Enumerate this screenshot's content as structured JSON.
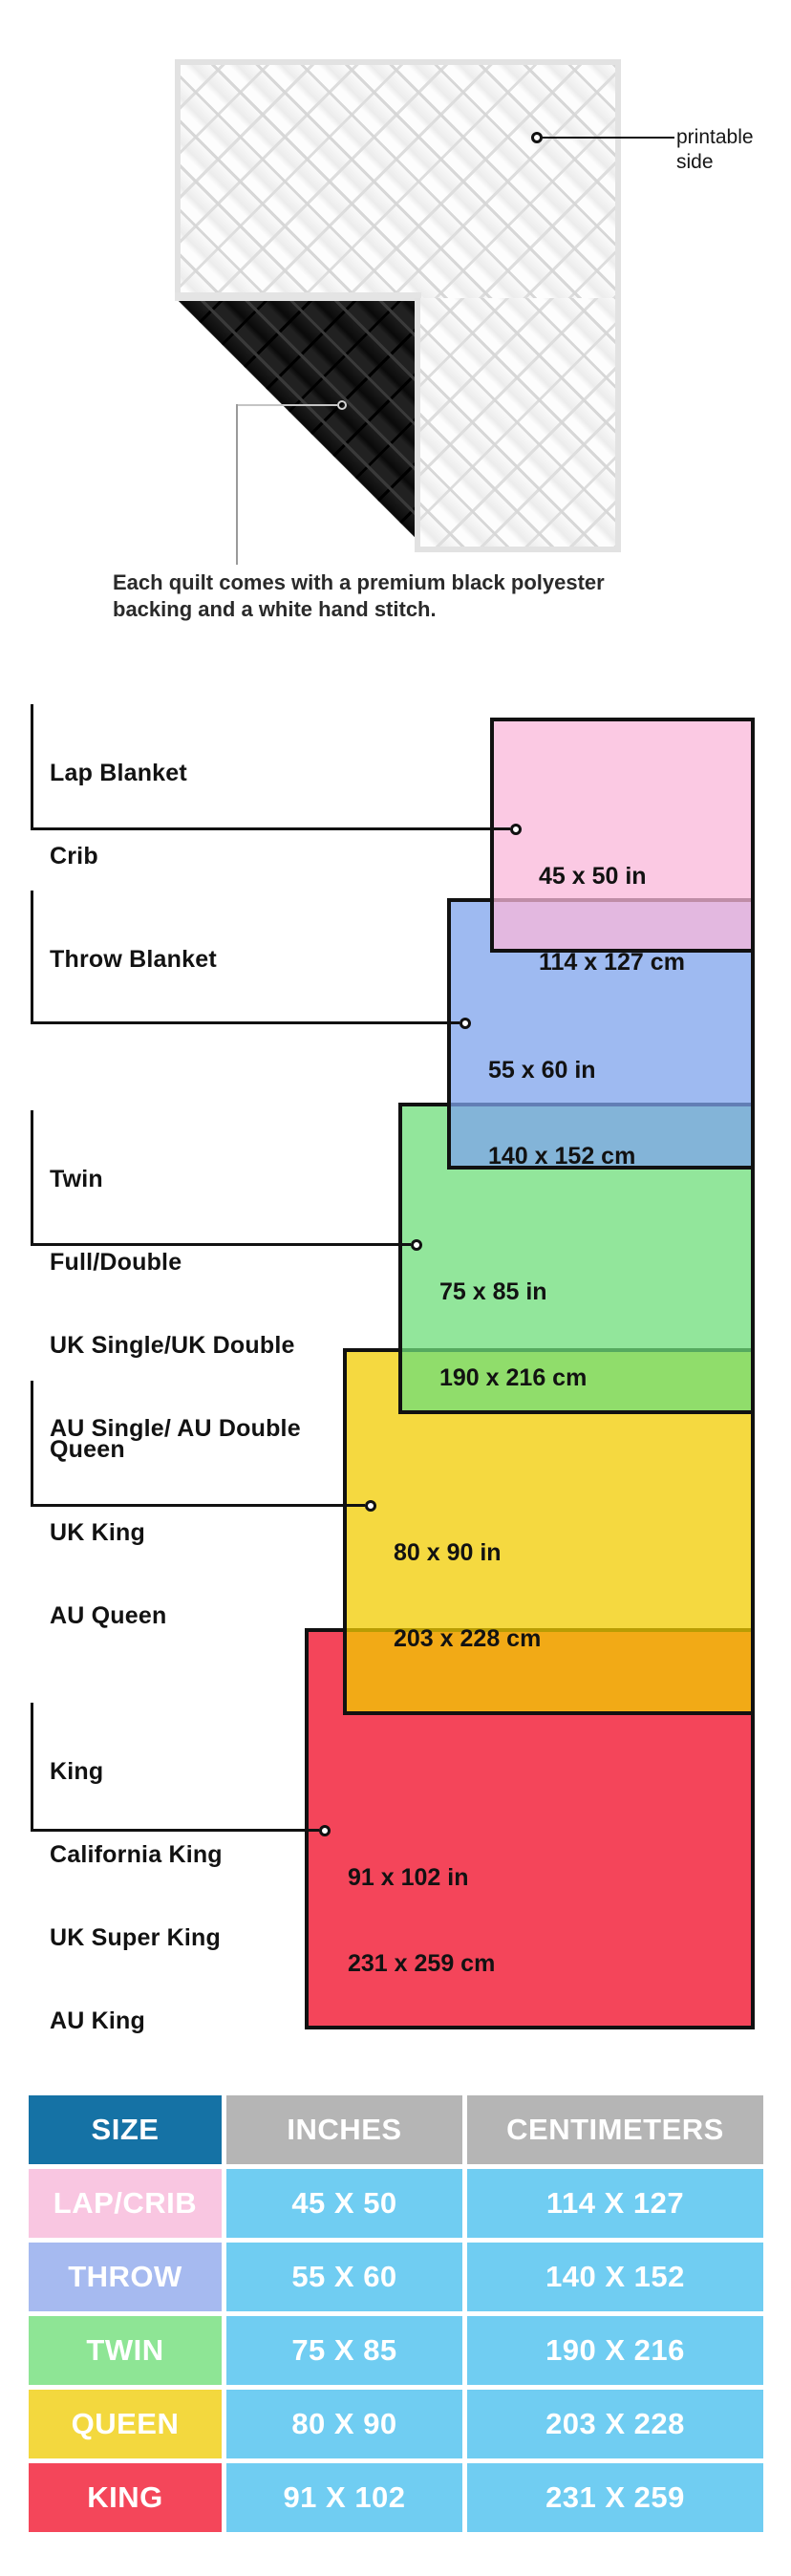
{
  "quilt": {
    "printable_label": {
      "line1": "printable",
      "line2": "side"
    },
    "caption": {
      "line1": "Each quilt comes with a premium black polyester",
      "line2": "backing and a white hand stitch."
    }
  },
  "diagram": {
    "sizes": [
      {
        "names": [
          "Lap Blanket",
          "Crib"
        ],
        "inches": "45 x 50 in",
        "cm": "114 x 127 cm",
        "color": "#FBC9E3"
      },
      {
        "names": [
          "Throw Blanket"
        ],
        "inches": "55 x 60 in",
        "cm": "140 x 152 cm",
        "color": "#9EBAF1"
      },
      {
        "names": [
          "Twin",
          "Full/Double",
          "UK Single/UK Double",
          "AU Single/ AU Double"
        ],
        "inches": "75 x 85 in",
        "cm": "190 x 216 cm",
        "color": "#92E69B"
      },
      {
        "names": [
          "Queen",
          "UK King",
          "AU Queen"
        ],
        "inches": "80 x 90 in",
        "cm": "203 x 228 cm",
        "color": "#F5D93F"
      },
      {
        "names": [
          "King",
          "California King",
          "UK Super King",
          "AU King"
        ],
        "inches": "91 x 102 in",
        "cm": "231 x 259 cm",
        "color": "#F4455A"
      }
    ],
    "overlap_colors": [
      "#E3B8E0",
      "#7FBCDF",
      "#8CDE5B",
      "#F2AA17"
    ]
  },
  "table": {
    "headers": {
      "size": "SIZE",
      "inches": "INCHES",
      "cm": "CENTIMETERS"
    },
    "header_colors": {
      "size_bg": "#1572A5",
      "other_bg": "#B5B5B5",
      "cell_bg": "#70CDF2"
    },
    "rows": [
      {
        "label": "LAP/CRIB",
        "inches": "45 X 50",
        "cm": "114 X 127",
        "color": "#F9C6E1"
      },
      {
        "label": "THROW",
        "inches": "55 X 60",
        "cm": "140 X 152",
        "color": "#A6BAF0"
      },
      {
        "label": "TWIN",
        "inches": "75 X 85",
        "cm": "190 X 216",
        "color": "#8EE595"
      },
      {
        "label": "QUEEN",
        "inches": "80 X 90",
        "cm": "203 X 228",
        "color": "#F3D83E"
      },
      {
        "label": "KING",
        "inches": "91 X 102",
        "cm": "231 X 259",
        "color": "#F4465A"
      }
    ]
  }
}
